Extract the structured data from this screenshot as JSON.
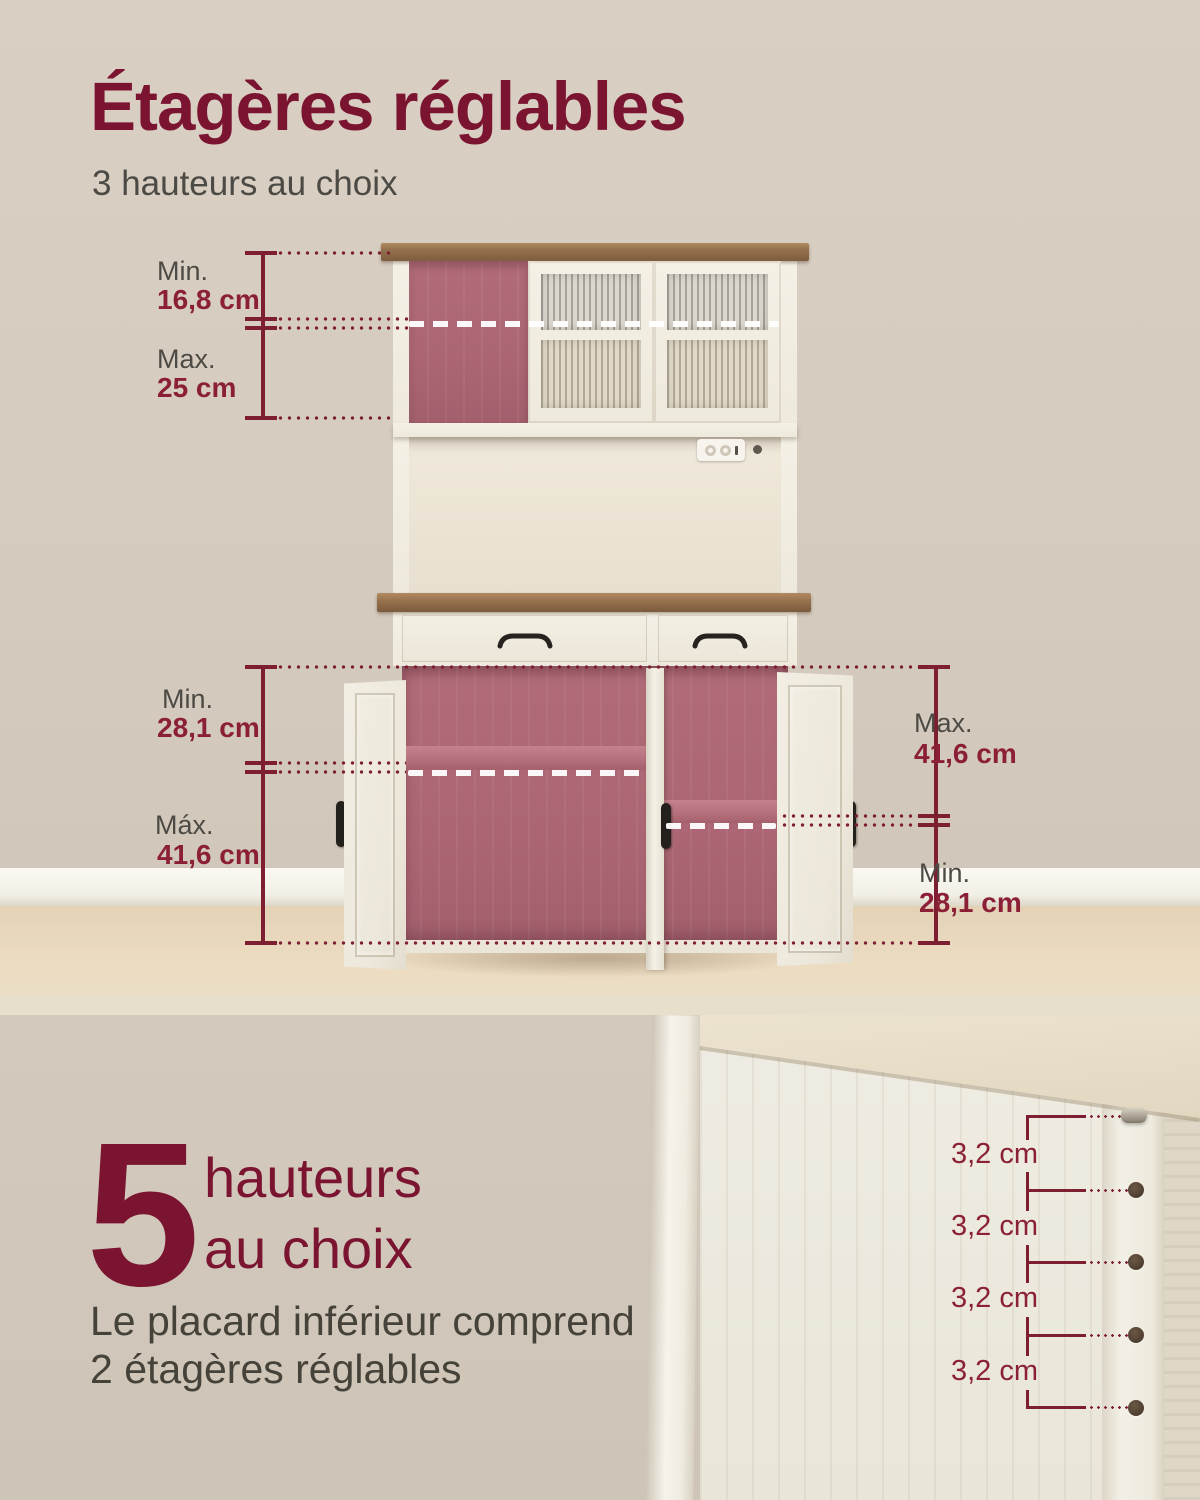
{
  "page": {
    "title": "Étagères réglables",
    "subtitle": "3 hauteurs au choix"
  },
  "colors": {
    "accent_maroon": "#7a1430",
    "measure_line": "#7d1f31",
    "label_gray": "#4b4843",
    "wall_beige": "#d7cdc1",
    "cabinet_white": "#f1ecdf",
    "interior_pink": "#ae6773",
    "wood_brown": "#8a664a"
  },
  "measure_groups": {
    "hutch": {
      "rows": [
        {
          "label": "Min.",
          "value": "16,8 cm"
        },
        {
          "label": "Max.",
          "value": "25 cm"
        }
      ]
    },
    "lower_left": {
      "rows": [
        {
          "label": "Min.",
          "value": "28,1 cm"
        },
        {
          "label": "Máx.",
          "value": "41,6 cm"
        }
      ]
    },
    "lower_right": {
      "rows": [
        {
          "label": "Max.",
          "value": "41,6 cm"
        },
        {
          "label": "Min.",
          "value": "28,1 cm"
        }
      ]
    }
  },
  "bottom": {
    "number": "5",
    "headline_line1": "hauteurs",
    "headline_line2": "au choix",
    "description_line1": "Le placard inférieur comprend",
    "description_line2": "2 étagères réglables",
    "shelf_pitch_labels": [
      "3,2 cm",
      "3,2 cm",
      "3,2 cm",
      "3,2 cm"
    ]
  }
}
